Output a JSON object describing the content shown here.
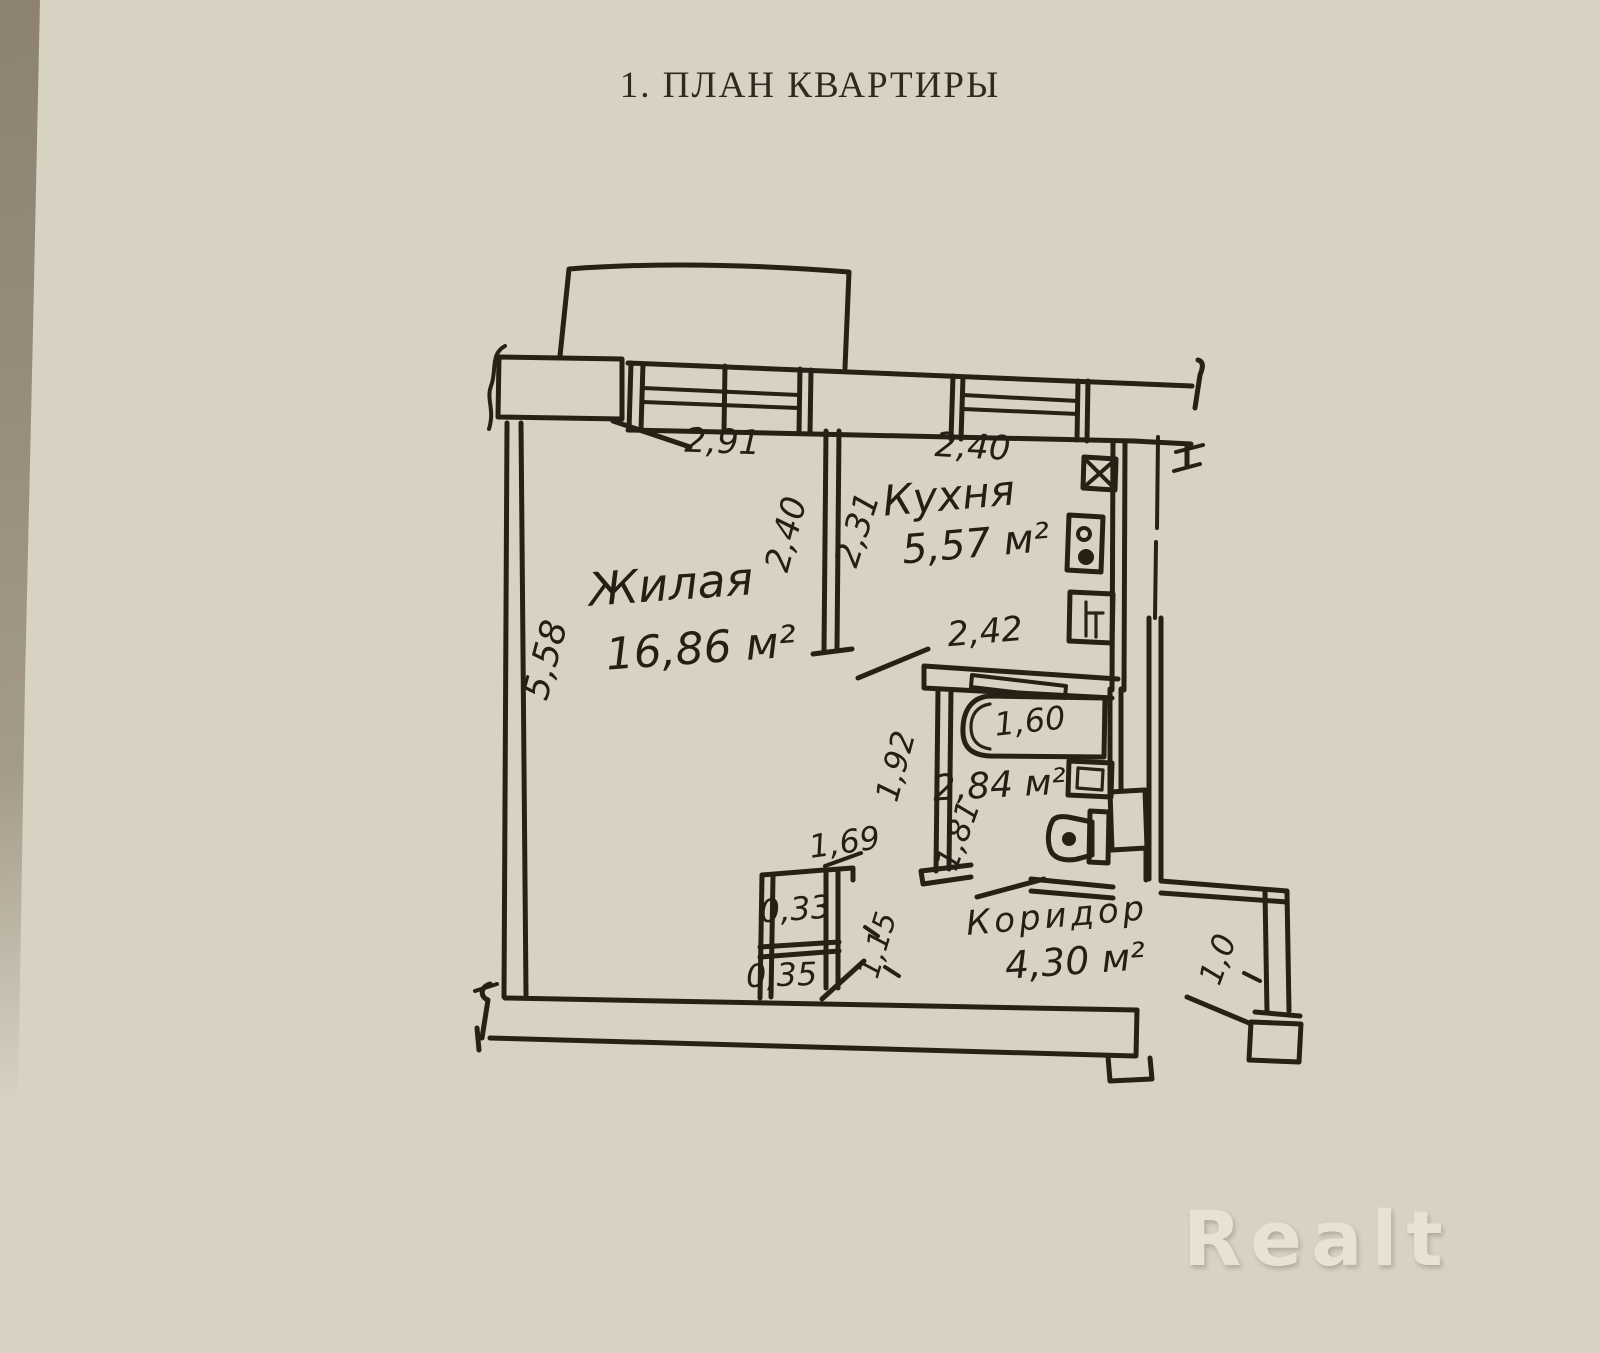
{
  "title": "1. ПЛАН КВАРТИРЫ",
  "watermark": "Realt",
  "plan": {
    "rooms": {
      "living": {
        "label": "Жилая",
        "area": "16,86 м²"
      },
      "kitchen": {
        "label": "Кухня",
        "area": "5,57 м²"
      },
      "bathroom": {
        "area": "2,84 м²"
      },
      "corridor": {
        "label": "Коридор",
        "area": "4,30 м²"
      }
    },
    "dims": {
      "living_window": "2,91",
      "kitchen_window": "2,40",
      "partition_living_side": "2,40",
      "partition_kitchen_side": "2,31",
      "living_left_wall": "5,58",
      "bathroom_top": "2,42",
      "bathtub": "1,60",
      "bathroom_left": "1,92",
      "bathroom_inner": "1,81",
      "closet_front": "1,69",
      "closet_upper_cell": "0,33",
      "closet_lower_cell": "0,35",
      "closet_side": "1,15",
      "entry_door": "1,0"
    },
    "colors": {
      "ink": "#262015",
      "paper": "#d8d2c3"
    }
  }
}
